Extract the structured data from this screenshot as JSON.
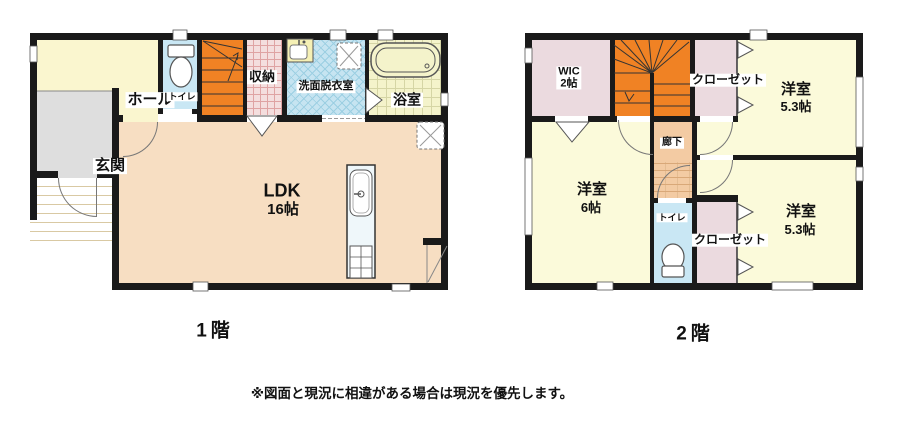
{
  "floor1": {
    "caption": "1階",
    "hall": "ホール",
    "entrance": "玄関",
    "toilet": "トイレ",
    "storage": "収納",
    "washroom": "洗面脱衣室",
    "bath": "浴室",
    "ldk_name": "LDK",
    "ldk_size": "16帖"
  },
  "floor2": {
    "caption": "2階",
    "wic_name": "WIC",
    "wic_size": "2帖",
    "closet_top": "クローゼット",
    "bedroom_tr_name": "洋室",
    "bedroom_tr_size": "5.3帖",
    "corridor": "廊下",
    "bedroom_left_name": "洋室",
    "bedroom_left_size": "6帖",
    "toilet": "トイレ",
    "closet_bottom": "クローゼット",
    "bedroom_br_name": "洋室",
    "bedroom_br_size": "5.3帖"
  },
  "disclaimer": "※図面と現況に相違がある場合は現況を優先します。",
  "colors": {
    "wall": "#1A1A1A",
    "stairs_orange": "#F08224",
    "ldk_floor": "#F7DEC2",
    "room_yellow_1f": "#FAF6CF",
    "room_yellow_2f": "#FBFADA",
    "bath_yellow": "#F4F3CB",
    "entrance_gray": "#DEDEDE",
    "closet_pink": "#EBDADF",
    "storage_pink": "#F4DEDE",
    "toilet_blue": "#C9E7F4",
    "washroom_blue": "#C6E4F1",
    "corridor_tan": "#F3CBA3"
  }
}
